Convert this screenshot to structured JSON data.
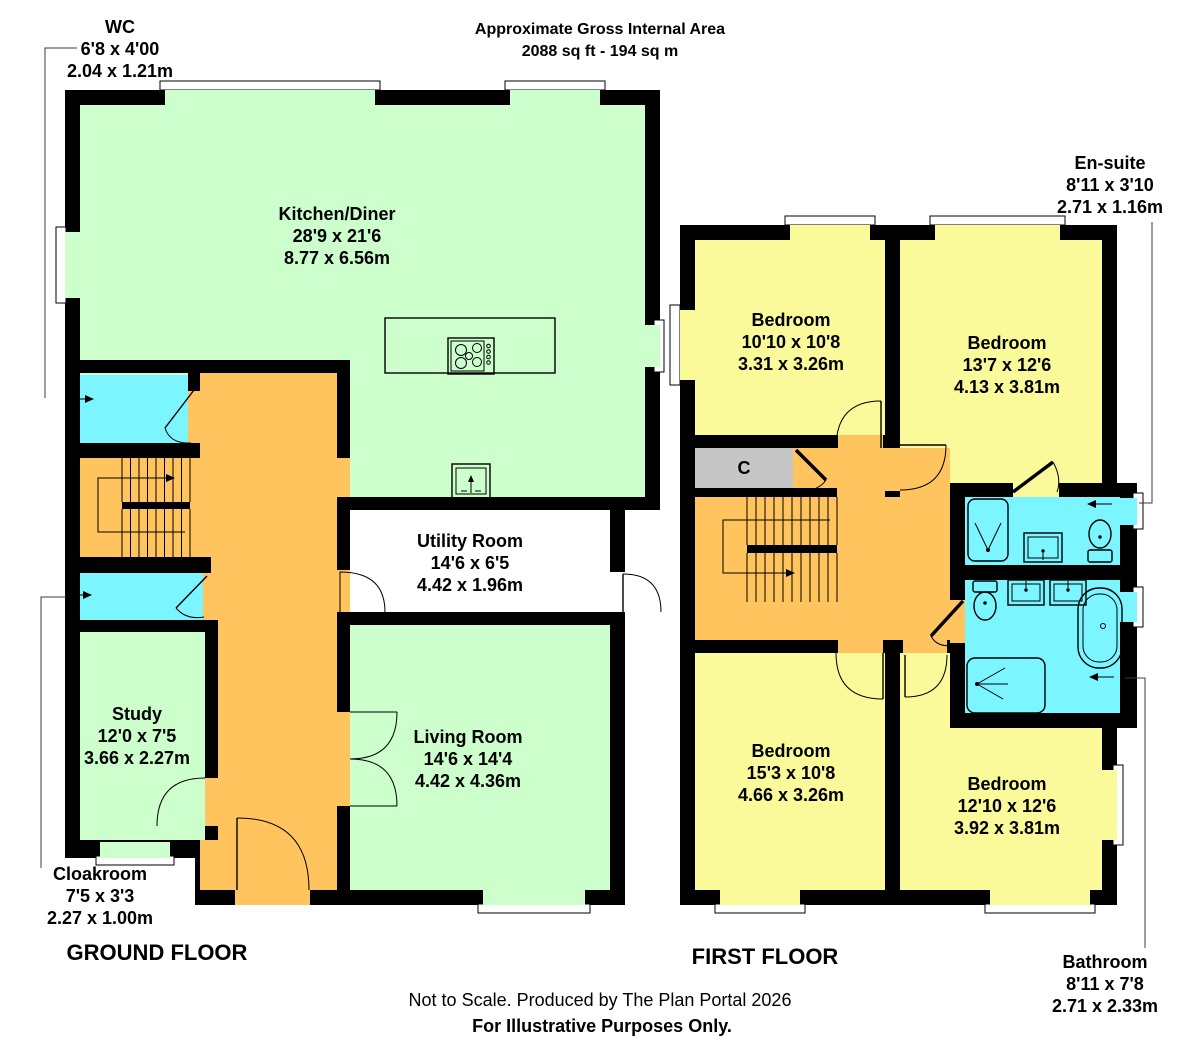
{
  "header": {
    "title": "Approximate Gross Internal Area",
    "area": "2088 sq ft - 194 sq m"
  },
  "ground_floor": {
    "title": "GROUND FLOOR",
    "rooms": {
      "wc": {
        "name": "WC",
        "imperial": "6'8 x 4'00",
        "metric": "2.04 x 1.21m"
      },
      "kitchen_diner": {
        "name": "Kitchen/Diner",
        "imperial": "28'9 x 21'6",
        "metric": "8.77 x 6.56m"
      },
      "utility": {
        "name": "Utility Room",
        "imperial": "14'6 x 6'5",
        "metric": "4.42 x 1.96m"
      },
      "study": {
        "name": "Study",
        "imperial": "12'0 x 7'5",
        "metric": "3.66 x 2.27m"
      },
      "living": {
        "name": "Living Room",
        "imperial": "14'6 x 14'4",
        "metric": "4.42 x 4.36m"
      },
      "cloakroom": {
        "name": "Cloakroom",
        "imperial": "7'5 x 3'3",
        "metric": "2.27 x 1.00m"
      }
    }
  },
  "first_floor": {
    "title": "FIRST FLOOR",
    "rooms": {
      "bedroom1": {
        "name": "Bedroom",
        "imperial": "10'10 x 10'8",
        "metric": "3.31 x 3.26m"
      },
      "bedroom2": {
        "name": "Bedroom",
        "imperial": "13'7 x 12'6",
        "metric": "4.13 x 3.81m"
      },
      "bedroom3": {
        "name": "Bedroom",
        "imperial": "15'3 x 10'8",
        "metric": "4.66 x 3.26m"
      },
      "bedroom4": {
        "name": "Bedroom",
        "imperial": "12'10 x 12'6",
        "metric": "3.92 x 3.81m"
      },
      "ensuite": {
        "name": "En-suite",
        "imperial": "8'11 x 3'10",
        "metric": "2.71 x 1.16m"
      },
      "bathroom": {
        "name": "Bathroom",
        "imperial": "8'11 x 7'8",
        "metric": "2.71 x 2.33m"
      },
      "closet": {
        "label": "C"
      }
    }
  },
  "footer": {
    "line1": "Not to Scale. Produced by The Plan Portal 2026",
    "line2": "For Illustrative Purposes Only."
  },
  "colors": {
    "room_green": "#CCFFCC",
    "room_yellow": "#FAFA9A",
    "room_cyan": "#7BF5FF",
    "hall_orange": "#FFC45E",
    "closet_gray": "#C6C6C6",
    "wall_black": "#000000",
    "background": "#FFFFFF"
  }
}
